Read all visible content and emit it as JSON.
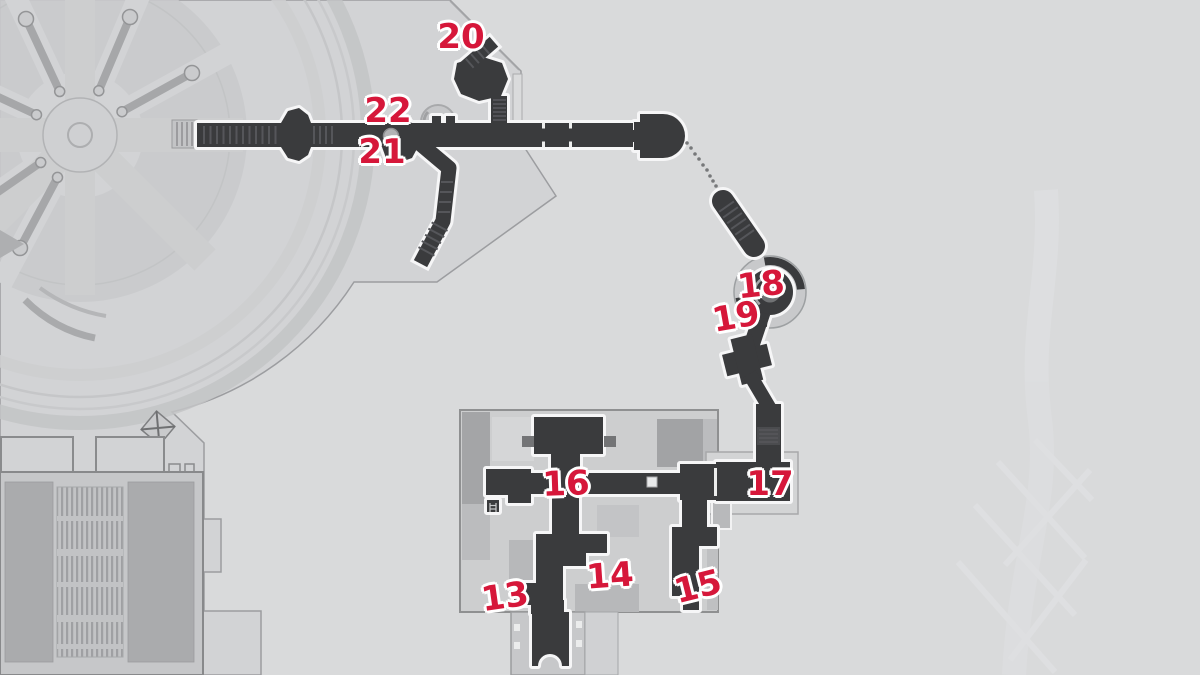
{
  "map": {
    "colors": {
      "background": "#d9dadb",
      "plaza": "#d2d3d5",
      "building": "#cdcecf",
      "corridor": "#3a3b3d",
      "corridor_outline": "#f6f6f7",
      "marker": "#d6173a",
      "marker_outline": "#ffffff"
    },
    "markers": [
      {
        "label": "13",
        "x": 505,
        "y": 597,
        "rotation": -8
      },
      {
        "label": "14",
        "x": 610,
        "y": 576,
        "rotation": -4
      },
      {
        "label": "15",
        "x": 698,
        "y": 587,
        "rotation": -14
      },
      {
        "label": "16",
        "x": 566,
        "y": 484,
        "rotation": -2
      },
      {
        "label": "17",
        "x": 770,
        "y": 484,
        "rotation": 0
      },
      {
        "label": "18",
        "x": 761,
        "y": 285,
        "rotation": -6
      },
      {
        "label": "19",
        "x": 736,
        "y": 317,
        "rotation": -10
      },
      {
        "label": "20",
        "x": 461,
        "y": 37,
        "rotation": 0
      },
      {
        "label": "21",
        "x": 382,
        "y": 152,
        "rotation": 0
      },
      {
        "label": "22",
        "x": 388,
        "y": 111,
        "rotation": 0
      }
    ]
  }
}
